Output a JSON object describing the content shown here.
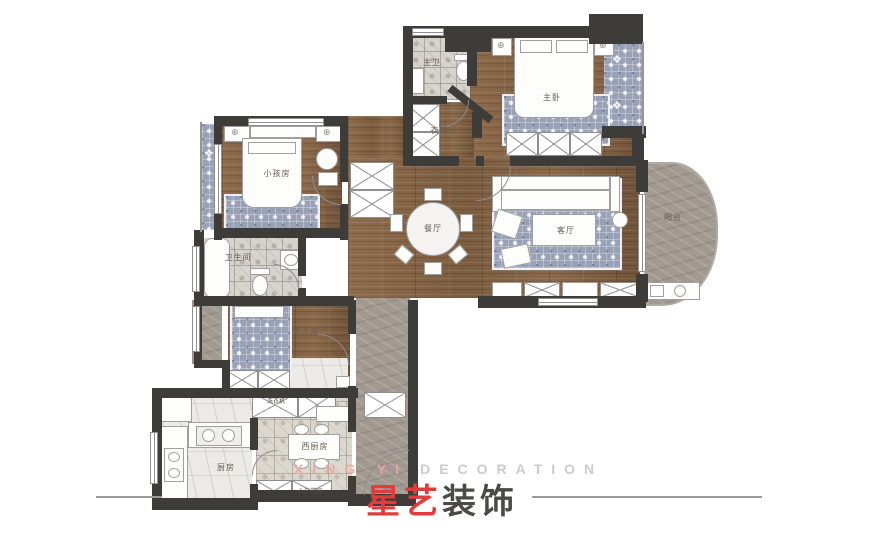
{
  "plan": {
    "type": "apartment-floor-plan",
    "colors": {
      "wall": "#3e3c39",
      "wood_floor": "#876749",
      "stone_floor": "#a29a90",
      "tile_floor": "#d7d3cd",
      "rug_blue": "#99a1b7",
      "logo_red": "#e23b3b",
      "logo_dark": "#4b4a47",
      "watermark_red": "#e9a7a2",
      "watermark_gray": "#c6c6c6"
    }
  },
  "rooms": [
    {
      "id": "master-bath",
      "label": "主卫"
    },
    {
      "id": "master-bedroom",
      "label": "主卧"
    },
    {
      "id": "cloakroom",
      "label": "衣帽间"
    },
    {
      "id": "kids-room",
      "label": "小孩房"
    },
    {
      "id": "dining-room",
      "label": "餐厅"
    },
    {
      "id": "living-room",
      "label": "客厅"
    },
    {
      "id": "balcony",
      "label": "阳台"
    },
    {
      "id": "bathroom",
      "label": "卫生间"
    },
    {
      "id": "elder-room",
      "label": "老人房"
    },
    {
      "id": "west-kitchen",
      "label": "西厨房"
    },
    {
      "id": "kitchen",
      "label": "厨房"
    }
  ],
  "fixtures": [
    {
      "id": "washing-machine",
      "label": "洗衣机"
    },
    {
      "id": "entry-garden",
      "label": "入户花园"
    }
  ],
  "brand": {
    "watermark_red": "XING YI",
    "watermark_gray": "DECORATION",
    "logo_red": "星艺",
    "logo_dark": "装饰"
  }
}
